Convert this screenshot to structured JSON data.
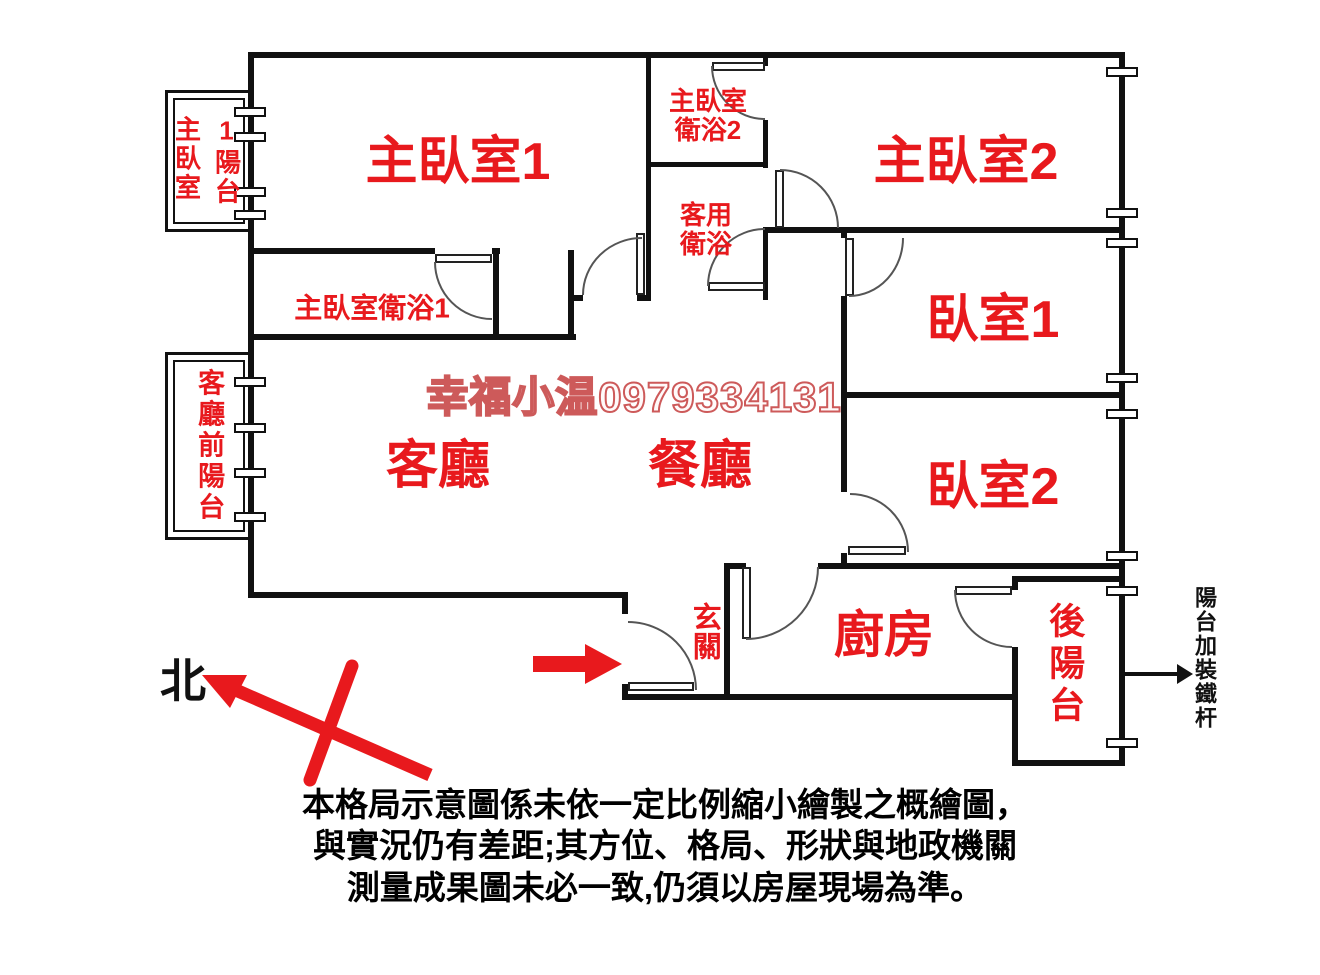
{
  "watermark": "幸福小温0979334131",
  "rooms": {
    "master_bedroom_1": "主臥室1",
    "master_bedroom_2": "主臥室2",
    "master_bath_2_line1": "主臥室",
    "master_bath_2_line2": "衛浴2",
    "guest_bath_line1": "客用",
    "guest_bath_line2": "衛浴",
    "master_bath_1": "主臥室衛浴1",
    "bedroom_1": "臥室1",
    "bedroom_2": "臥室2",
    "living_room": "客廳",
    "dining_room": "餐廳",
    "entry": "玄關",
    "kitchen": "廚房",
    "back_balcony": "後陽台",
    "master_balcony_col_left": "主臥室",
    "master_balcony_col_right": "1陽台",
    "front_balcony": "客廳前陽台"
  },
  "compass": {
    "north_label": "北"
  },
  "notes": {
    "balcony_iron_bar": "陽台加裝鐵杆"
  },
  "disclaimer": {
    "line1": "本格局示意圖係未依一定比例縮小繪製之概繪圖，",
    "line2": "與實況仍有差距;其方位、格局、形狀與地政機關",
    "line3": "測量成果圖未必一致,仍須以房屋現場為準。"
  },
  "colors": {
    "label_red": "#e8191d",
    "wall_black": "#111111",
    "watermark_red": "#cd5a5a"
  }
}
